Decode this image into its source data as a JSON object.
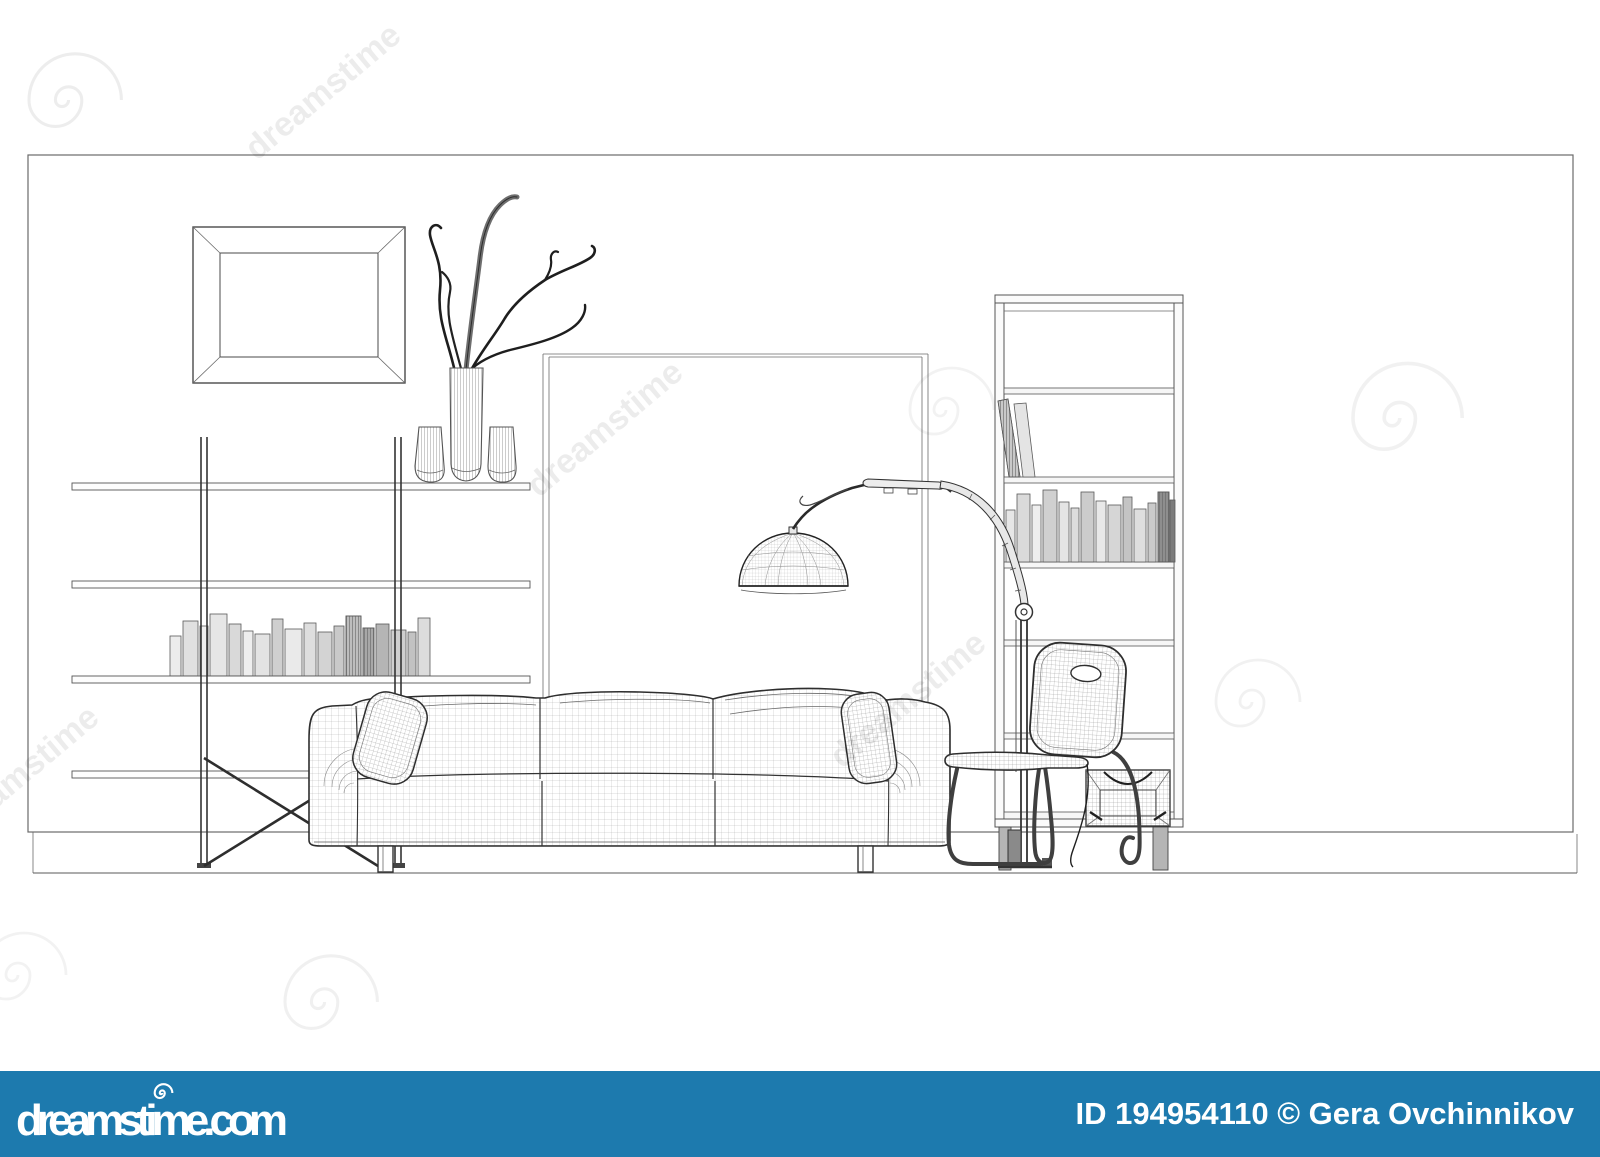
{
  "page": {
    "background": "#ffffff"
  },
  "artwork": {
    "type": "3d-wireframe-interior-rendering",
    "line_color": "#3a3a3a",
    "objects": [
      "wall panel",
      "picture frame",
      "wall shelf unit",
      "books",
      "vases with branches",
      "arc floor lamp",
      "three-seat sofa",
      "pillows",
      "shell chair",
      "bookcase",
      "wire basket"
    ]
  },
  "watermark": {
    "text": "dreamstime",
    "color": "#000000"
  },
  "footer": {
    "background": "#1d7aae",
    "text_color": "#ffffff",
    "site": "dreamstime.com",
    "credit": "ID 194954110 © Gera Ovchinnikov"
  }
}
